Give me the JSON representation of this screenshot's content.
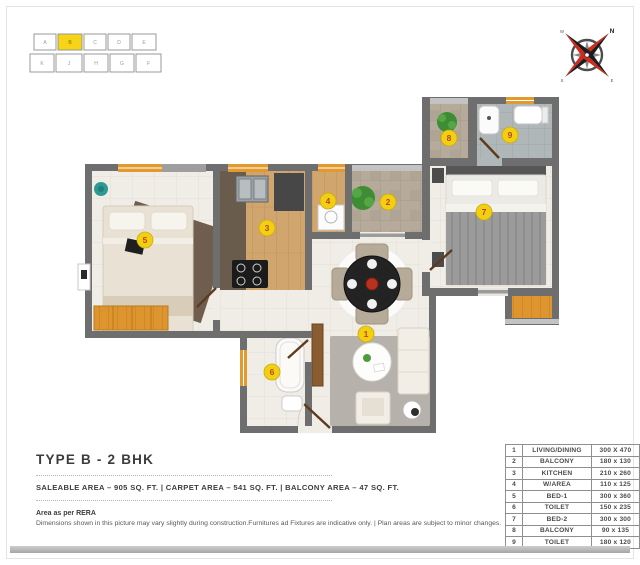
{
  "key_plan": {
    "top_units": [
      "A",
      "B",
      "C",
      "D",
      "E"
    ],
    "bottom_units": [
      "K",
      "J",
      "H",
      "G",
      "F"
    ],
    "highlighted_unit": "B"
  },
  "compass": {
    "labels": {
      "ne": "N",
      "nw": "W",
      "sw": "S",
      "se": "E"
    }
  },
  "floor_plan": {
    "markers": [
      {
        "num": "1",
        "room": "LIVING/DINING",
        "x": 366,
        "y": 334
      },
      {
        "num": "2",
        "room": "BALCONY",
        "x": 388,
        "y": 202
      },
      {
        "num": "3",
        "room": "KITCHEN",
        "x": 267,
        "y": 228
      },
      {
        "num": "4",
        "room": "W/AREA",
        "x": 328,
        "y": 201
      },
      {
        "num": "5",
        "room": "BED-1",
        "x": 145,
        "y": 240
      },
      {
        "num": "6",
        "room": "TOILET",
        "x": 272,
        "y": 372
      },
      {
        "num": "7",
        "room": "BED-2",
        "x": 484,
        "y": 212
      },
      {
        "num": "8",
        "room": "BALCONY",
        "x": 449,
        "y": 138
      },
      {
        "num": "9",
        "room": "TOILET",
        "x": 510,
        "y": 135
      }
    ]
  },
  "info": {
    "title": "TYPE B - 2 BHK",
    "areas": "SALEABLE AREA – 905 SQ. FT.   |   CARPET AREA – 541 SQ. FT.   |   BALCONY AREA – 47 SQ. FT.",
    "rera": "Area as per RERA",
    "disclaimer": "Dimensions shown in this picture may vary slightly during construction.Furnitures ad Fixtures are indicative only.  | Plan areas are subject to minor changes."
  },
  "legend": {
    "rows": [
      {
        "no": "1",
        "name": "LIVING/DINING",
        "size": "300 X 470"
      },
      {
        "no": "2",
        "name": "BALCONY",
        "size": "180 x 130"
      },
      {
        "no": "3",
        "name": "KITCHEN",
        "size": "210 x 260"
      },
      {
        "no": "4",
        "name": "W/AREA",
        "size": "110 x 125"
      },
      {
        "no": "5",
        "name": "BED-1",
        "size": "300 x 360"
      },
      {
        "no": "6",
        "name": "TOILET",
        "size": "150 x 235"
      },
      {
        "no": "7",
        "name": "BED-2",
        "size": "300 x 300"
      },
      {
        "no": "8",
        "name": "BALCONY",
        "size": "90 x 135"
      },
      {
        "no": "9",
        "name": "TOILET",
        "size": "180 x 120"
      }
    ]
  },
  "colors": {
    "marker": "#f2cf12",
    "marker_stroke": "#cda90c",
    "marker_text": "#b44a1c",
    "wall": "#6e6e6e",
    "highlight": "#f5d516",
    "accent_wood": "#de9530",
    "compass_red": "#cf2a1b",
    "compass_black": "#1c1c1c"
  }
}
